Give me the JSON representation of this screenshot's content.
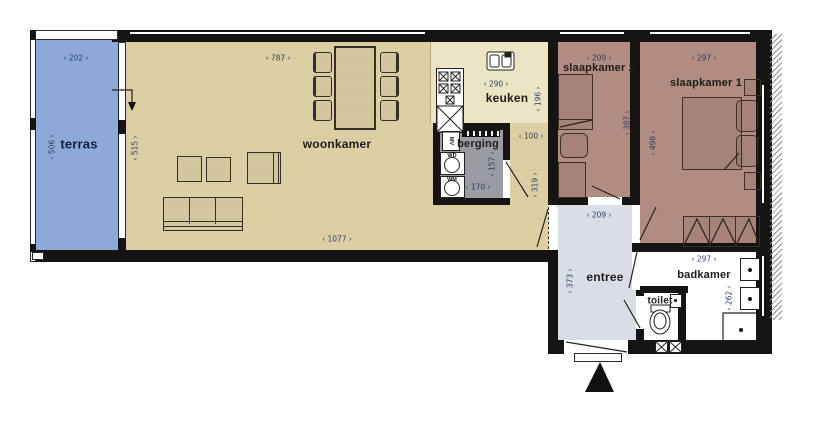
{
  "rooms": {
    "terras": {
      "label": "terras",
      "dim_w": "‹ 202 ›",
      "dim_h": "‹ 506 ›"
    },
    "woonkamer": {
      "label": "woonkamer",
      "dim_w": "‹ 787 ›",
      "dim_h": "‹ 515 ›",
      "dim_total_w": "‹ 1077 ›"
    },
    "keuken": {
      "label": "keuken",
      "dim_w": "‹ 290 ›",
      "dim_h": "‹ 196 ›"
    },
    "berging": {
      "label": "berging",
      "dim_w": "‹ 170 ›",
      "dim_h": "‹ 157 ›"
    },
    "gang": {
      "dim_w": "‹ 100 ›",
      "dim_h": "‹ 319 ›"
    },
    "slaapkamer2": {
      "label": "slaapkamer 2",
      "dim_w": "‹ 209 ›",
      "dim_h": "‹ 387 ›"
    },
    "slaapkamer1": {
      "label": "slaapkamer 1",
      "dim_w": "‹ 297 ›",
      "dim_h": "‹ 498 ›"
    },
    "entree": {
      "label": "entree",
      "dim_w": "‹ 209 ›",
      "dim_h": "‹ 373 ›"
    },
    "badkamer": {
      "label": "badkamer",
      "dim_w": "‹ 297 ›",
      "dim_h": "‹ 262 ›"
    },
    "toilet": {
      "label": "toilet"
    }
  },
  "appliances": {
    "mv": "MV",
    "wd": "WD",
    "wm": "WM"
  },
  "colors": {
    "terras": "#8ca9d8",
    "woonkamer": "#dccfa3",
    "keuken": "#ece5c4",
    "berging": "#9b9ba3",
    "slaapkamer": "#b28b81",
    "entree": "#d9dde6",
    "bathroom": "#ffffff",
    "wall": "#161412",
    "dimension_text": "#2e3f66"
  }
}
